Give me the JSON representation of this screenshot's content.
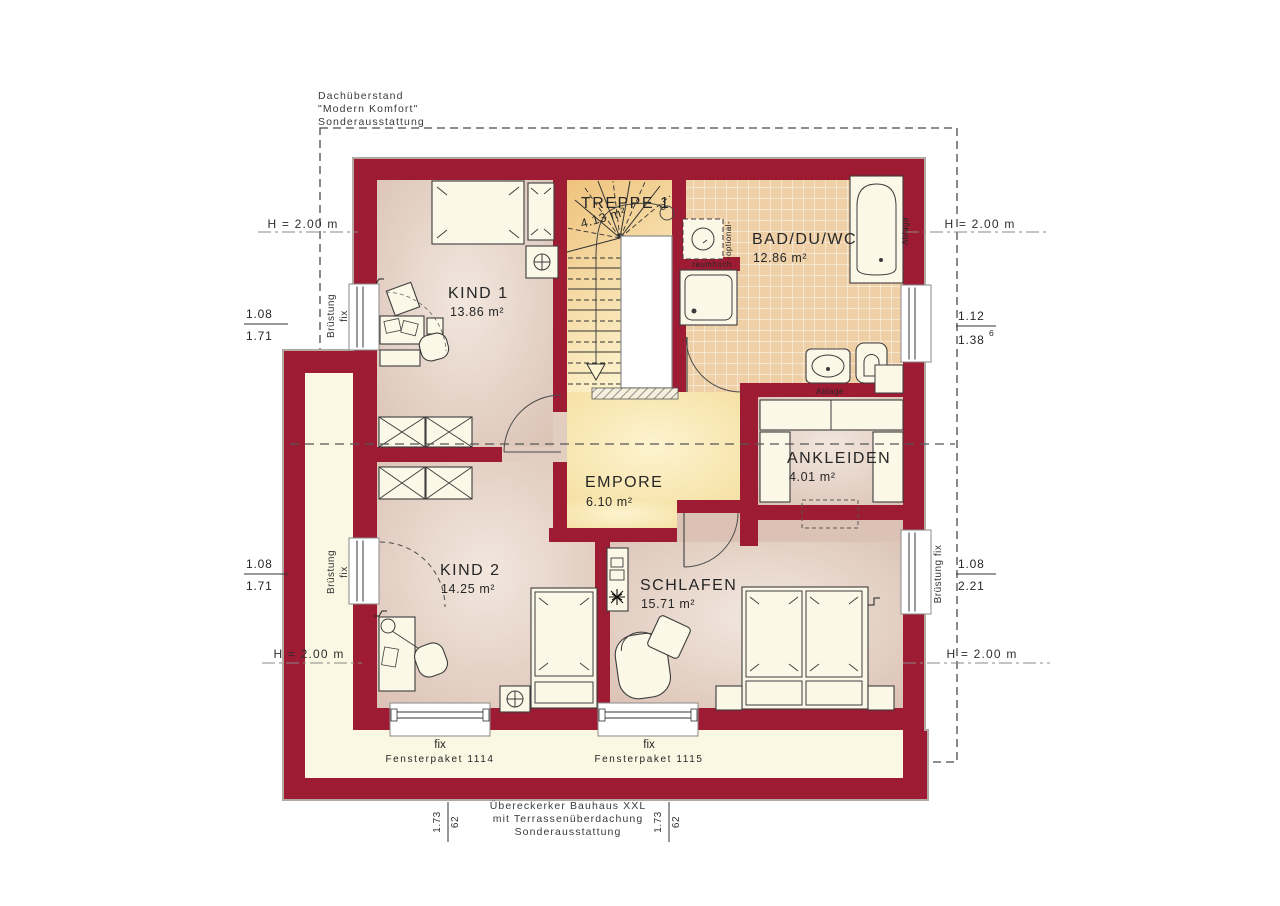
{
  "plan_title": "Obergeschoss Grundriss",
  "colors": {
    "wall": "#9e1c33",
    "room_floor": "#dcc2b4",
    "gallery_floor": "#f6dfa0",
    "bath_tile": "#eecfa6",
    "terrace": "#faf7e2"
  },
  "notes": {
    "roof": {
      "l1": "Dachüberstand",
      "l2": "\"Modern Komfort\"",
      "l3": "Sonderausstattung"
    },
    "terrace": {
      "l1": "Übereckerker Bauhaus XXL",
      "l2": "mit Terrassenüberdachung",
      "l3": "Sonderausstattung"
    }
  },
  "rooms": {
    "kind1": {
      "name": "KIND 1",
      "area": "13.86 m²"
    },
    "treppe": {
      "name": "TREPPE 1",
      "area": "4.13 m²"
    },
    "bad": {
      "name": "BAD/DU/WC",
      "area": "12.86 m²"
    },
    "empore": {
      "name": "EMPORE",
      "area": "6.10 m²"
    },
    "ankleiden": {
      "name": "ANKLEIDEN",
      "area": "4.01 m²"
    },
    "kind2": {
      "name": "KIND 2",
      "area": "14.25 m²"
    },
    "schlafen": {
      "name": "SCHLAFEN",
      "area": "15.71 m²"
    }
  },
  "dims": {
    "height": "H = 2.00 m",
    "frac_left_top": {
      "num": "1.08",
      "den": "1.71"
    },
    "frac_right_top": {
      "num": "1.12",
      "den": "1.38",
      "sup": "6"
    },
    "frac_left_bottom": {
      "num": "1.08",
      "den": "1.71"
    },
    "frac_right_bottom": {
      "num": "1.08",
      "den": "2.21"
    },
    "pair_left": {
      "a": "1.73",
      "b": "62"
    },
    "pair_right": {
      "a": "1.73",
      "b": "62"
    }
  },
  "windows": {
    "bruestung": {
      "line1": "Brüstung",
      "line2": "fix"
    },
    "bruestung_right": "Brüstung fix",
    "south1": {
      "fix": "fix",
      "pkg": "Fensterpaket 1114"
    },
    "south2": {
      "fix": "fix",
      "pkg": "Fensterpaket 1115"
    }
  },
  "labels": {
    "raumhoch": "raumhoch",
    "optional": "-optional-",
    "ablage_tub": "Ablage",
    "ablage_bath": "Ablage"
  }
}
